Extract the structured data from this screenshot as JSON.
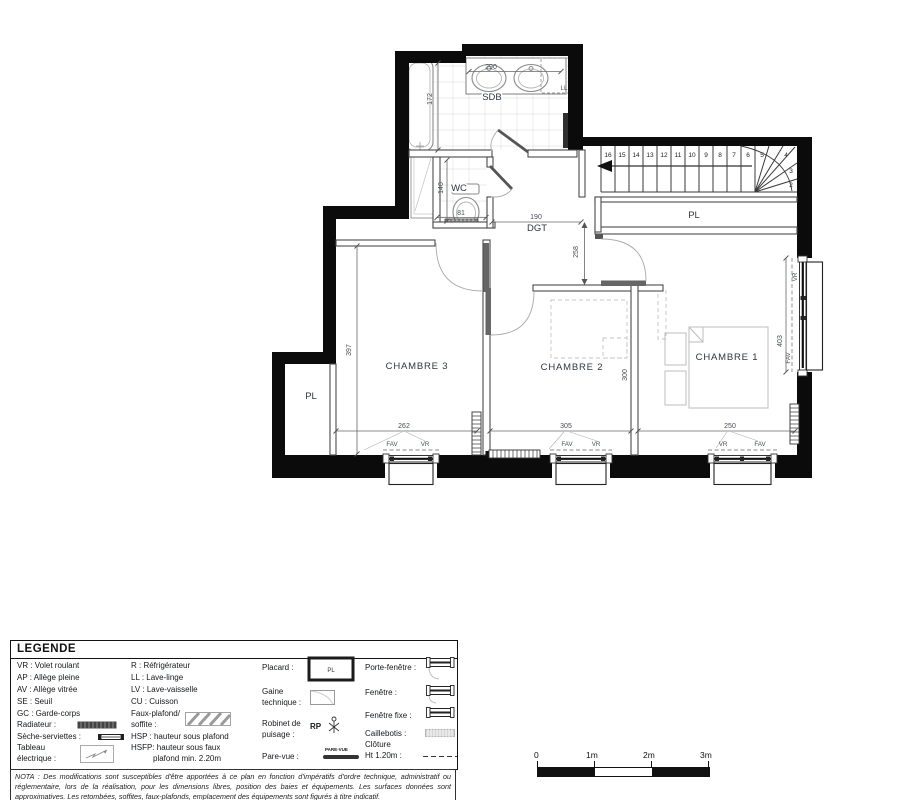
{
  "plan": {
    "rooms": {
      "sdb": "SDB",
      "wc": "WC",
      "dgt": "DGT",
      "chambre1": "CHAMBRE 1",
      "chambre2": "CHAMBRE 2",
      "chambre3": "CHAMBRE 3",
      "pl_stairs": "PL",
      "pl_left": "PL"
    },
    "appliances": {
      "ll": "LL"
    },
    "dims": {
      "vanity": "290",
      "bathtub": "172",
      "wc_depth": "140",
      "wc_width": "81",
      "dgt_width": "190",
      "dgt_depth": "258",
      "chambre3_depth": "397",
      "chambre2_depth": "300",
      "window1": "262",
      "window2": "305",
      "window3": "250",
      "window_right": "403"
    },
    "windows": {
      "w1_left": "FAV",
      "w1_right": "VR",
      "w2_left": "FAV",
      "w2_right": "VR",
      "w3_left": "VR",
      "w3_right": "FAV",
      "right_top": "VR",
      "right_bottom": "FAV"
    },
    "stairs": {
      "steps": [
        "16",
        "15",
        "14",
        "13",
        "12",
        "11",
        "10",
        "9",
        "8",
        "7",
        "6",
        "5",
        "4",
        "3",
        "2"
      ]
    }
  },
  "legend": {
    "title": "LEGENDE",
    "col1": {
      "vr": "VR : Volet roulant",
      "ap": "AP : Allège pleine",
      "av": "AV : Allège vitrée",
      "se": "SE : Seuil",
      "gc": "GC : Garde-corps",
      "radiateur": "Radiateur :",
      "seche": "Sèche-serviettes :",
      "tableau_l1": "Tableau",
      "tableau_l2": "électrique :"
    },
    "col2": {
      "r": "R : Réfrigérateur",
      "ll": "LL : Lave-linge",
      "lv": "LV : Lave-vaisselle",
      "cu": "CU : Cuisson",
      "faux_l1": "Faux-plafond/",
      "faux_l2": "soffite :",
      "hsp": "HSP : hauteur sous plafond",
      "hsfp_l1": "HSFP: hauteur sous faux",
      "hsfp_l2": "plafond min. 2.20m"
    },
    "col3": {
      "placard": "Placard :",
      "placard_sym": "PL",
      "gaine_l1": "Gaine",
      "gaine_l2": "technique :",
      "robinet_l1": "Robinet de",
      "robinet_l2": "puisage :",
      "rp": "RP",
      "parevue": "Pare-vue :",
      "parevue_sym": "PARE-VUE"
    },
    "col4": {
      "porte_fenetre": "Porte-fenêtre :",
      "fenetre": "Fenêtre :",
      "fenetre_fixe": "Fenêtre fixe :",
      "caillebotis": "Caillebotis :",
      "cloture_l1": "Clôture",
      "cloture_l2": "Ht 1.20m :"
    }
  },
  "nota": "NOTA : Des modifications sont susceptibles d'être apportées à ce plan en fonction d'impératifs d'ordre technique, administratif ou réglementaire, lors de la réalisation, pour les dimensions libres, position des baies et équipements. Les surfaces données sont approximatives. Les retombées, soffites, faux-plafonds, emplacement des équipements sont figurés à titre indicatif.",
  "scalebar": {
    "t0": "0",
    "t1": "1m",
    "t2": "2m",
    "t3": "3m"
  }
}
